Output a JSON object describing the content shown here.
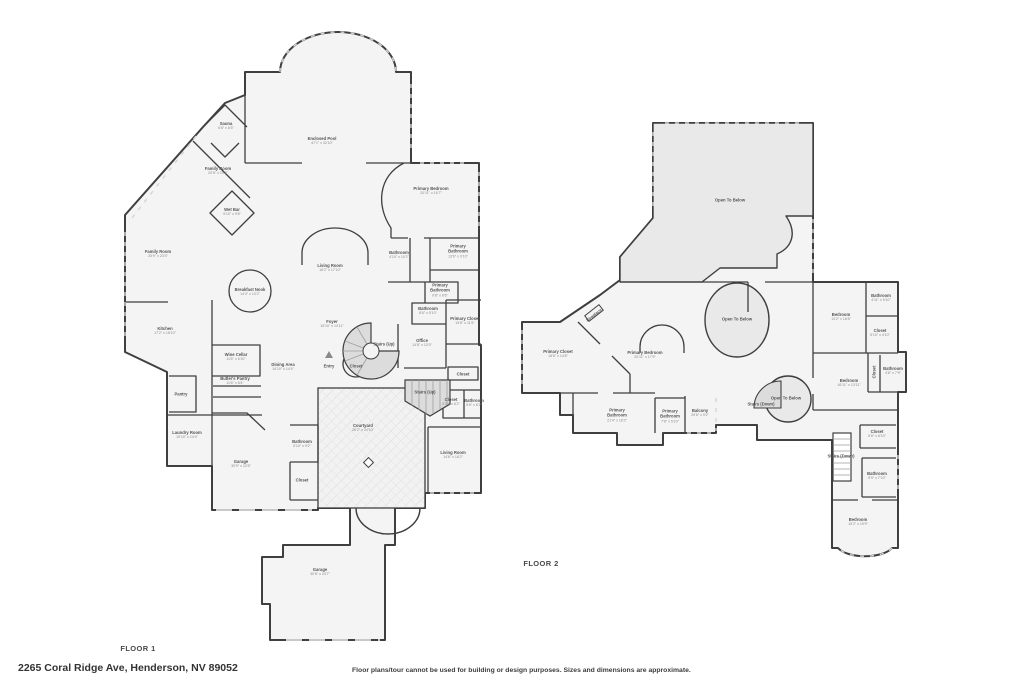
{
  "footer": {
    "address": "2265 Coral Ridge Ave, Henderson, NV 89052",
    "disclaimer": "Floor plans/tour cannot be used for building or design purposes. Sizes and dimensions are approximate."
  },
  "colors": {
    "wall": "#3f3f3f",
    "room_fill": "#f4f4f4",
    "open_to_below_fill": "#e9e9e9",
    "stair_fill": "#dcdcdc",
    "window_dash": "#d4d4d4"
  },
  "floors": {
    "floor1": {
      "label": "FLOOR 1",
      "rooms": [
        {
          "name": "Sauna",
          "dims": "6'8\" x 6'5\"",
          "x": 226,
          "y": 126
        },
        {
          "name": "Family Room",
          "dims": "20'6\" x 19'3\"",
          "x": 218,
          "y": 171
        },
        {
          "name": "Enclosed Pool",
          "dims": "47'1\" x 32'10\"",
          "x": 322,
          "y": 141
        },
        {
          "name": "Wet Bar",
          "dims": "9'10\" x 9'8\"",
          "x": 232,
          "y": 212
        },
        {
          "name": "Family Room",
          "dims": "25'9\" x 23'4\"",
          "x": 158,
          "y": 254
        },
        {
          "name": "Primary Bedroom",
          "dims": "20'11\" x 16'7\"",
          "x": 431,
          "y": 191
        },
        {
          "name": "Bathroom",
          "dims": "4'10\" x 10'2\"",
          "x": 399,
          "y": 255
        },
        {
          "name": "Primary Bathroom",
          "dims": "13'6\" x 9'10\"",
          "x": 458,
          "y": 251
        },
        {
          "name": "Living Room",
          "dims": "18'2\" x 17'10\"",
          "x": 330,
          "y": 268
        },
        {
          "name": "Breakfast Nook",
          "dims": "14'4\" x 13'2\"",
          "x": 250,
          "y": 292
        },
        {
          "name": "Primary Bathroom",
          "dims": "9'8\" x 8'6\"",
          "x": 440,
          "y": 290
        },
        {
          "name": "Bathroom",
          "dims": "8'6\" x 5'10\"",
          "x": 428,
          "y": 311
        },
        {
          "name": "Primary Closet",
          "dims": "15'8\" x 11'5\"",
          "x": 465,
          "y": 321
        },
        {
          "name": "Kitchen",
          "dims": "17'2\" x 18'10\"",
          "x": 165,
          "y": 331
        },
        {
          "name": "Foyer",
          "dims": "15'10\" x 13'11\"",
          "x": 332,
          "y": 324
        },
        {
          "name": "Office",
          "dims": "14'8\" x 12'0\"",
          "x": 422,
          "y": 343
        },
        {
          "name": "Stairs (Up)",
          "x": 384,
          "y": 344
        },
        {
          "name": "Wine Cellar",
          "dims": "11'6\" x 6'10\"",
          "x": 236,
          "y": 357
        },
        {
          "name": "Dining Area",
          "dims": "14'10\" x 14'4\"",
          "x": 283,
          "y": 367
        },
        {
          "name": "Entry",
          "x": 329,
          "y": 366
        },
        {
          "name": "Closet",
          "x": 356,
          "y": 366
        },
        {
          "name": "Butler's Pantry",
          "dims": "11'6\" x 6'4\"",
          "x": 235,
          "y": 381
        },
        {
          "name": "Pantry",
          "x": 181,
          "y": 394
        },
        {
          "name": "Closet",
          "x": 463,
          "y": 374
        },
        {
          "name": "Stairs (Up)",
          "x": 425,
          "y": 392
        },
        {
          "name": "Closet",
          "dims": "4'10\" x 6'2\"",
          "x": 451,
          "y": 402
        },
        {
          "name": "Bathroom",
          "dims": "5'6\" x 8'2\"",
          "x": 474,
          "y": 403
        },
        {
          "name": "Laundry Room",
          "dims": "10'10\" x 14'4\"",
          "x": 187,
          "y": 435
        },
        {
          "name": "Bathroom",
          "dims": "5'10\" x 9'2\"",
          "x": 302,
          "y": 444
        },
        {
          "name": "Courtyard",
          "dims": "26'2\" x 24'10\"",
          "x": 363,
          "y": 428
        },
        {
          "name": "Living Room",
          "dims": "14'6\" x 18'2\"",
          "x": 453,
          "y": 455
        },
        {
          "name": "Garage",
          "dims": "30'9\" x 23'5\"",
          "x": 241,
          "y": 464
        },
        {
          "name": "Closet",
          "x": 302,
          "y": 480
        },
        {
          "name": "Garage",
          "dims": "30'8\" x 24'7\"",
          "x": 320,
          "y": 572
        }
      ]
    },
    "floor2": {
      "label": "FLOOR 2",
      "rooms": [
        {
          "name": "Open To Below",
          "x": 730,
          "y": 200
        },
        {
          "name": "Open To Below",
          "x": 737,
          "y": 319
        },
        {
          "name": "Bathroom",
          "dims": "4'11\" x 5'10\"",
          "x": 881,
          "y": 298
        },
        {
          "name": "Bedroom",
          "dims": "13'2\" x 16'8\"",
          "x": 841,
          "y": 317
        },
        {
          "name": "Closet",
          "dims": "5'10\" x 4'10\"",
          "x": 880,
          "y": 333
        },
        {
          "name": "Primary Closet",
          "dims": "18'6\" x 14'8\"",
          "x": 558,
          "y": 354
        },
        {
          "name": "Fireplace",
          "x": 594,
          "y": 315,
          "rot": -38
        },
        {
          "name": "Primary Bedroom",
          "dims": "20'11\" x 17'9\"",
          "x": 645,
          "y": 355
        },
        {
          "name": "Closet",
          "x": 874,
          "y": 372,
          "vert": true
        },
        {
          "name": "Bathroom",
          "dims": "4'8\" x 7'9\"",
          "x": 893,
          "y": 371
        },
        {
          "name": "Bedroom",
          "dims": "16'11\" x 13'11\"",
          "x": 849,
          "y": 383
        },
        {
          "name": "Open To Below",
          "x": 786,
          "y": 398
        },
        {
          "name": "Stairs (Down)",
          "x": 761,
          "y": 404
        },
        {
          "name": "Primary Bathroom",
          "dims": "21'4\" x 16'2\"",
          "x": 617,
          "y": 415
        },
        {
          "name": "Primary Bathroom",
          "dims": "7'8\" x 5'10\"",
          "x": 670,
          "y": 416
        },
        {
          "name": "Balcony",
          "dims": "20'8\" x 9'2\"",
          "x": 700,
          "y": 413
        },
        {
          "name": "Closet",
          "dims": "5'8\" x 6'10\"",
          "x": 877,
          "y": 434
        },
        {
          "name": "Stairs (Down)",
          "x": 841,
          "y": 456
        },
        {
          "name": "Bathroom",
          "dims": "9'9\" x 7'10\"",
          "x": 877,
          "y": 476
        },
        {
          "name": "Bedroom",
          "dims": "15'2\" x 19'9\"",
          "x": 858,
          "y": 522
        }
      ]
    }
  }
}
